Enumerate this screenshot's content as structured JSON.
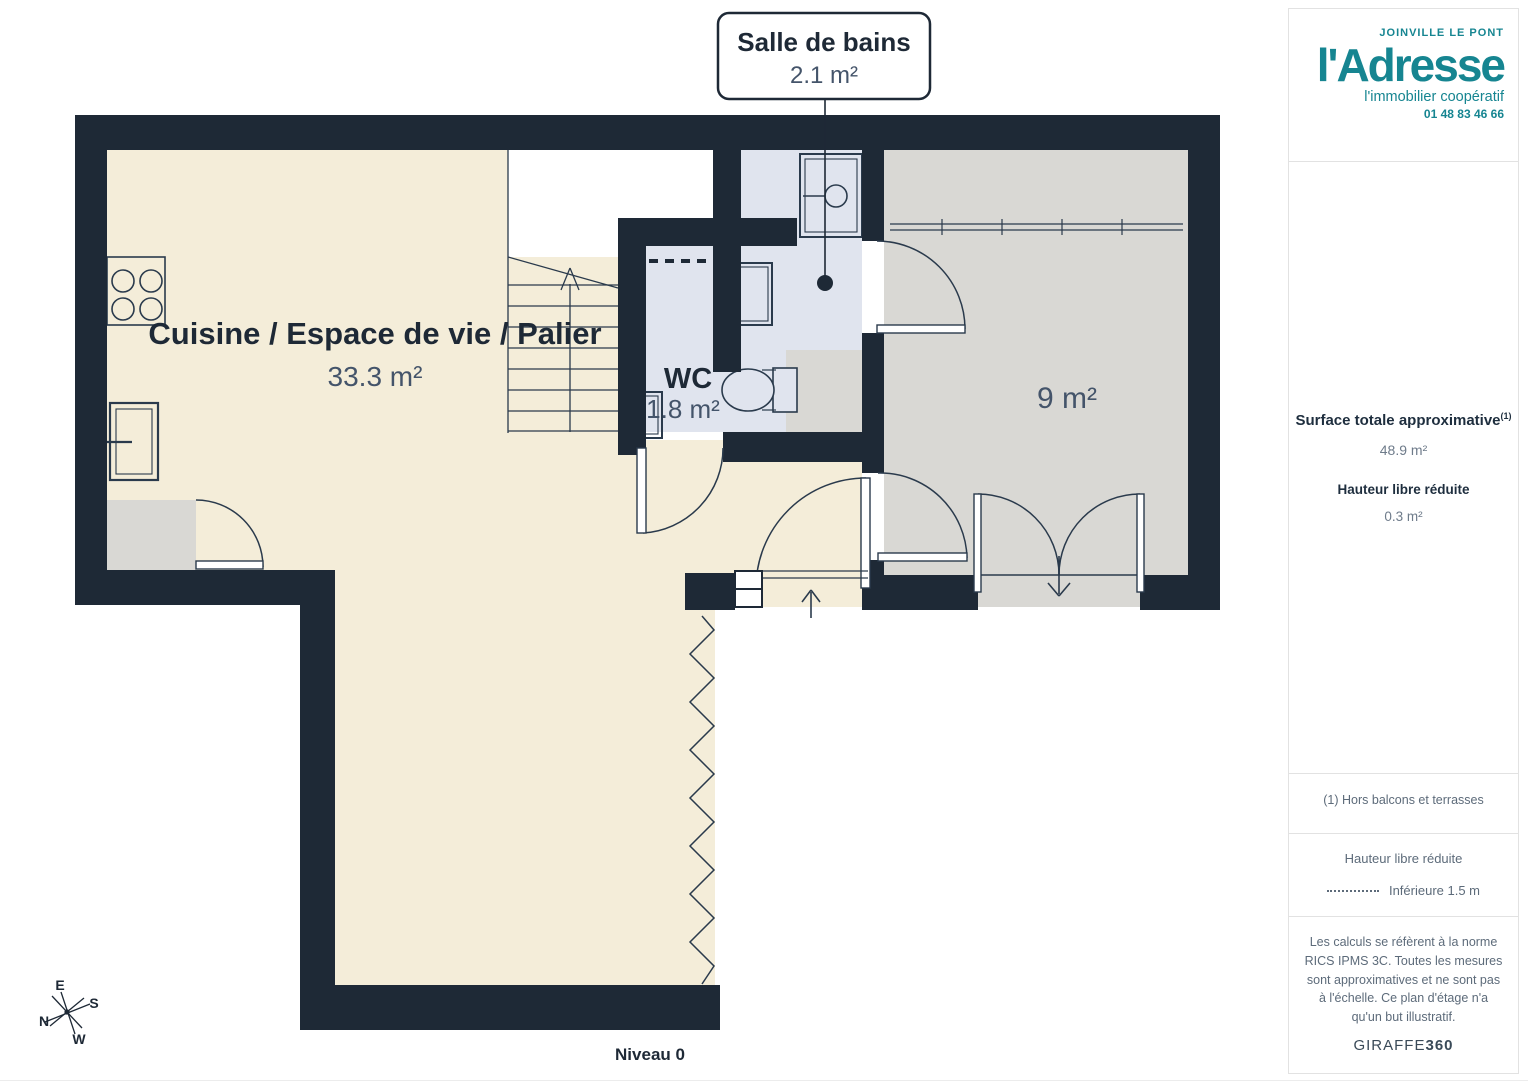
{
  "plan": {
    "callout": {
      "title": "Salle de bains",
      "area": "2.1 m²"
    },
    "rooms": {
      "main": {
        "name": "Cuisine / Espace de vie / Palier",
        "area": "33.3 m²"
      },
      "wc": {
        "name": "WC",
        "area": "1.8 m²"
      },
      "bedroom": {
        "area": "9 m²"
      }
    },
    "level_label": "Niveau 0",
    "compass": {
      "n": "N",
      "s": "S",
      "e": "E",
      "w": "W"
    },
    "colors": {
      "wall": "#1e2936",
      "floor_beige": "#f4edd9",
      "floor_gray": "#d9d8d4",
      "floor_wet": "#e0e4ee",
      "line": "#2a3a4c",
      "area_text": "#44546a"
    }
  },
  "sidebar": {
    "brand": {
      "city": "JOINVILLE LE PONT",
      "name": "l'Adresse",
      "tagline": "l'immobilier coopératif",
      "phone": "01 48 83 46 66",
      "color": "#168591"
    },
    "surface": {
      "label": "Surface totale approximative",
      "footnote_mark": "(1)",
      "value": "48.9 m²",
      "reduced_label": "Hauteur libre réduite",
      "reduced_value": "0.3 m²"
    },
    "footnote": "(1) Hors balcons et terrasses",
    "legend": {
      "title": "Hauteur libre réduite",
      "item": "Inférieure 1.5 m"
    },
    "disclaimer": "Les calculs se réfèrent à la norme RICS IPMS 3C. Toutes les mesures sont approximatives et ne sont pas à l'échelle. Ce plan d'étage n'a qu'un but illustratif.",
    "brand_footer": {
      "part1": "GIRAFFE",
      "part2": "360"
    }
  }
}
